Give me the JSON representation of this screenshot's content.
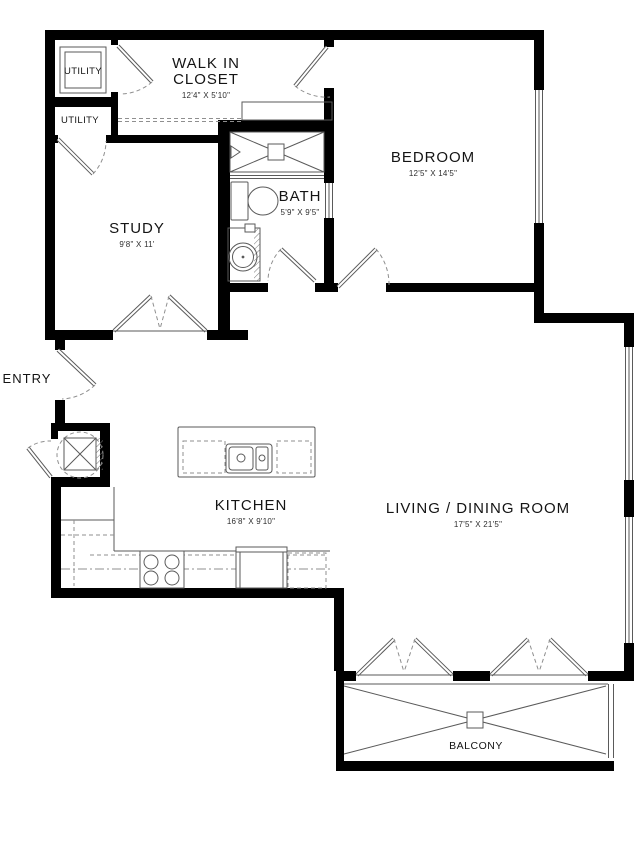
{
  "colors": {
    "wall": "#000000",
    "line": "#5a5a5a",
    "dashed_line": "#8f8f8f",
    "text": "#141414",
    "dim_text": "#2e2e2e",
    "background": "#ffffff"
  },
  "rooms": {
    "walk_in_closet": {
      "name": "WALK IN CLOSET",
      "dimensions": "12'4\" X 5'10\""
    },
    "bedroom": {
      "name": "BEDROOM",
      "dimensions": "12'5\" X 14'5\""
    },
    "bath": {
      "name": "BATH",
      "dimensions": "5'9\" X 9'5\""
    },
    "study": {
      "name": "STUDY",
      "dimensions": "9'8\" X 11'"
    },
    "kitchen": {
      "name": "KITCHEN",
      "dimensions": "16'8\" X 9'10\""
    },
    "living_dining": {
      "name": "LIVING / DINING ROOM",
      "dimensions": "17'5\" X 21'5\""
    },
    "entry": {
      "name": "ENTRY"
    },
    "balcony": {
      "name": "BALCONY"
    },
    "utility_top": {
      "name": "UTILITY"
    },
    "utility_bottom": {
      "name": "UTILITY"
    }
  }
}
